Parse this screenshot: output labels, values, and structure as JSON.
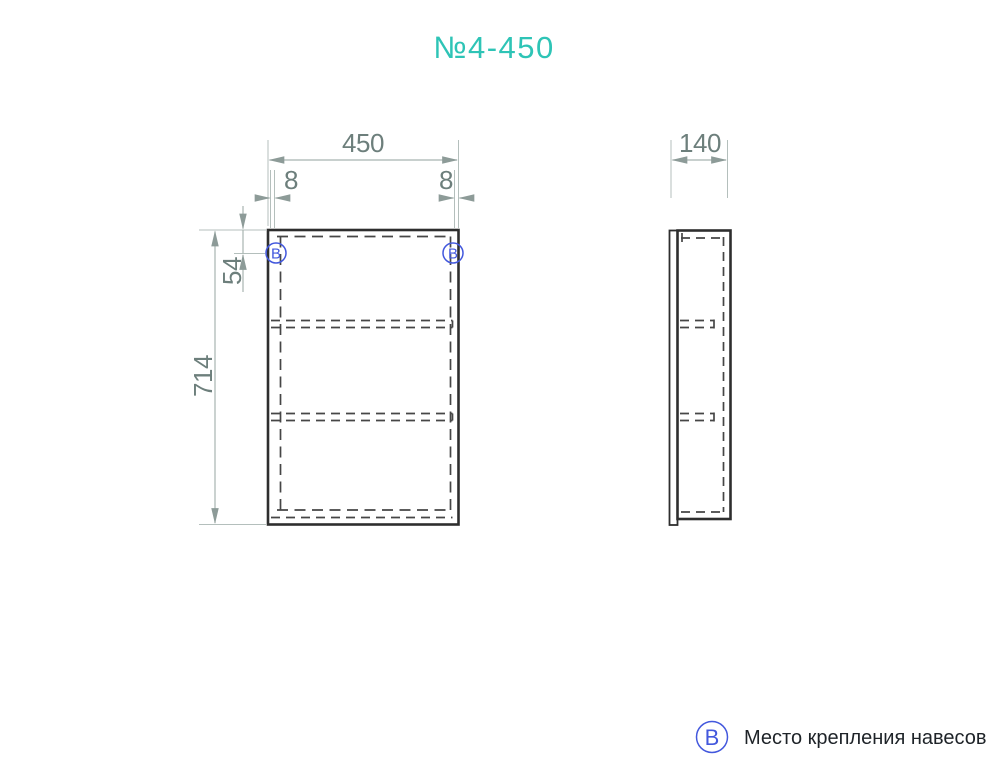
{
  "title": "№4-450",
  "colors": {
    "accent_teal": "#2ec4b6",
    "marker_blue": "#4358dd",
    "drawing_line": "#2e2e2e",
    "dimension_line": "#a8b4b1",
    "dimension_text": "#6d7f7c",
    "legend_text": "#1e2328"
  },
  "front_view": {
    "dimensions": {
      "width": "450",
      "height": "714",
      "left_hinge_offset": "8",
      "right_hinge_offset": "8",
      "hinge_top_offset": "54"
    },
    "hinge_marker": "В"
  },
  "side_view": {
    "dimensions": {
      "depth": "140"
    }
  },
  "legend": {
    "symbol": "В",
    "label": "Место крепления навесов"
  }
}
